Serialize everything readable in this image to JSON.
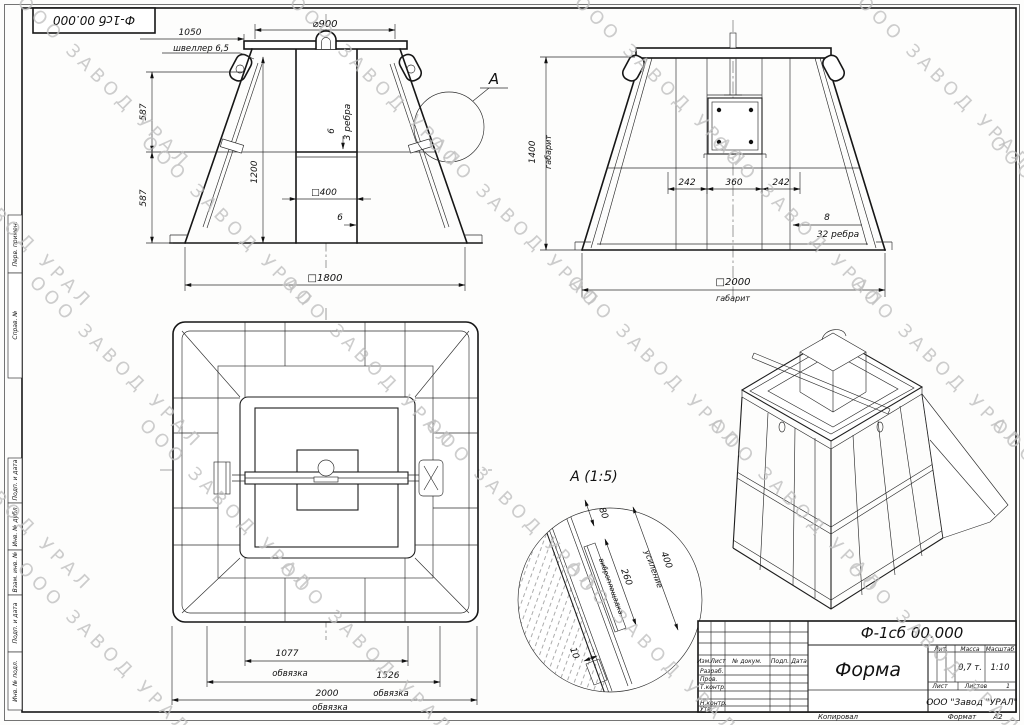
{
  "watermark": {
    "text": "ООО ЗАВОД УРАЛ"
  },
  "corner_stamp": {
    "doc_number": "Ф-1сб 00.000"
  },
  "side_strips": {
    "perv_primen": "Перв. примен.",
    "sprav_no": "Справ. №",
    "podp_data_1": "Подп. и дата",
    "inv_dubl": "Инв. № дубл.",
    "vzam_inv": "Взам. инв. №",
    "podp_data_2": "Подп. и дата",
    "inv_podl": "Инв. № подл."
  },
  "front_view": {
    "dia900": "⌀900",
    "dim1050": "1050",
    "channel_label": "швеллер 6,5",
    "dim587_top": "587",
    "dim587_bottom": "587",
    "dim1200": "1200",
    "thk6_mid": "6",
    "ribs3_label": "3 ребра",
    "sq400": "□400",
    "thk6_bottom": "6",
    "sq1800": "□1800",
    "callout_letter": "А"
  },
  "side_view": {
    "dim1400": "1400",
    "gabarit_vert": "габарит",
    "dim242_left": "242",
    "dim360": "360",
    "dim242_right": "242",
    "thk8": "8",
    "ribs32_label": "32 ребра",
    "sq2000": "□2000",
    "gabarit_horiz": "габарит"
  },
  "plan_view": {
    "dim1077": "1077",
    "obvyazka_1": "обвязка",
    "dim1526": "1526",
    "obvyazka_2": "обвязка",
    "dim2000": "2000",
    "obvyazka_3": "обвязка"
  },
  "detail_a": {
    "title": "А (1:5)",
    "dim80": "80",
    "dim260": "260",
    "vibro_label": "виброплощадка",
    "dim400": "400",
    "usilenie_label": "усиление",
    "dim10": "10"
  },
  "title_block": {
    "doc_number": "Ф-1сб 00.000",
    "part_name": "Форма",
    "col_izm": "Изм.",
    "col_list": "Лист",
    "col_ndoc": "№ докум.",
    "col_podp": "Подп.",
    "col_data": "Дата",
    "row_razrab": "Разраб.",
    "row_prov": "Пров.",
    "row_tkontr": "Т.контр.",
    "row_nkontr": "Н.контр.",
    "row_utv": "Утв.",
    "lit_label": "Лит.",
    "mass_label": "Масса",
    "scale_label": "Масштаб",
    "mass_value": "0,7 т.",
    "scale_value": "1:10",
    "sheet_label": "Лист",
    "sheets_label": "Листов",
    "sheets_value": "1",
    "company": "ООО \"Завод \"УРАЛ\"",
    "kopiroval": "Копировал",
    "format_label": "Формат",
    "format_value": "А2"
  }
}
